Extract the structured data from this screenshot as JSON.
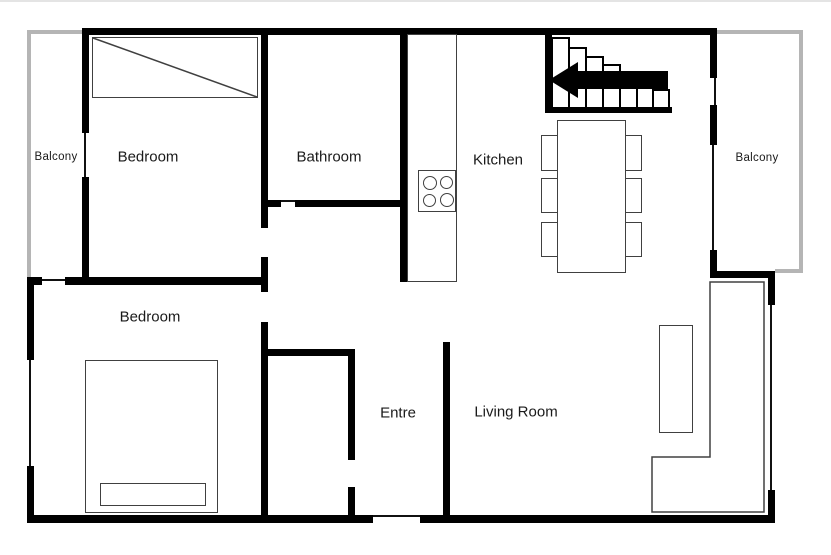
{
  "rooms": {
    "balcony_left": "Balcony",
    "bedroom_top": "Bedroom",
    "bathroom": "Bathroom",
    "kitchen": "Kitchen",
    "balcony_right": "Balcony",
    "bedroom_bottom": "Bedroom",
    "entre": "Entre",
    "living_room": "Living Room"
  },
  "colors": {
    "wall": "#000000",
    "furniture_outline": "#404040",
    "balcony_outline": "#b5b5b5",
    "background": "#ffffff"
  }
}
